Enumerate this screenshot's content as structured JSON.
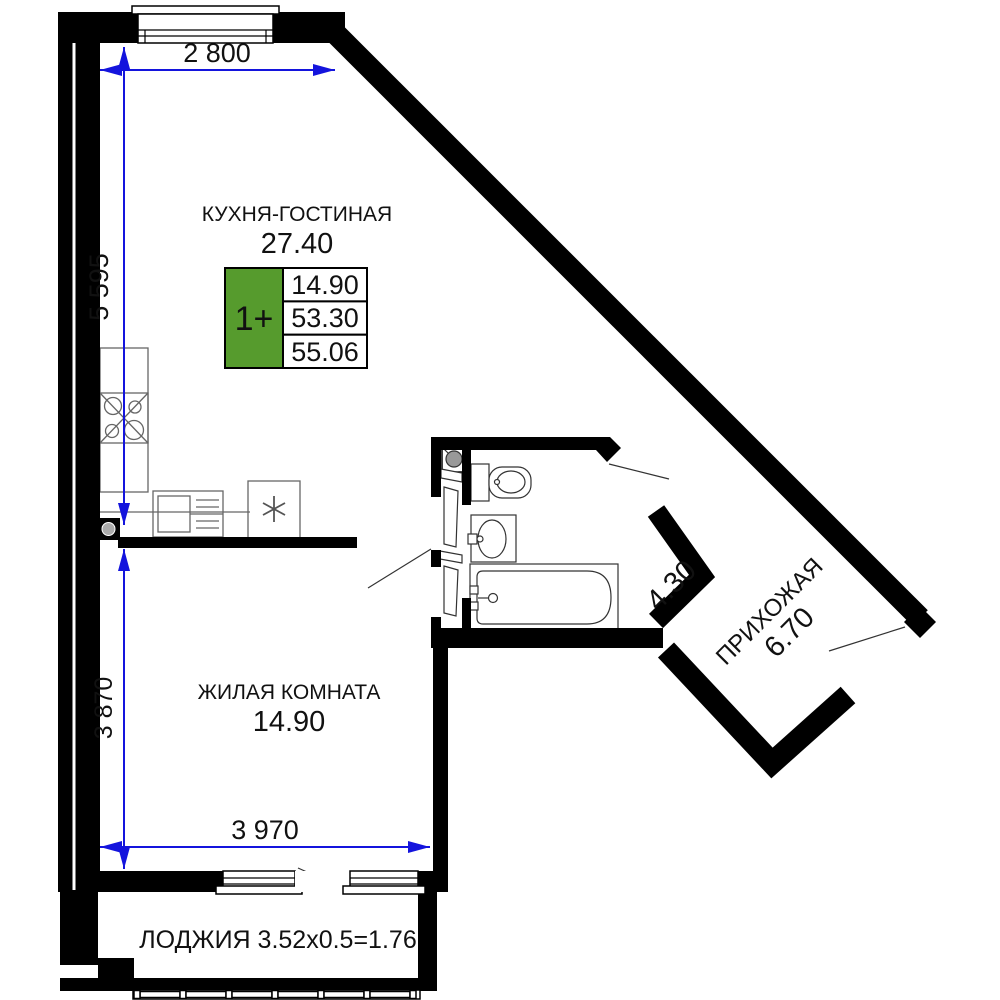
{
  "plan": {
    "dimensions": {
      "top": "2 800",
      "left_upper": "5 595",
      "left_lower": "3 870",
      "bottom": "3 970"
    },
    "rooms": {
      "kitchen_living": {
        "name": "КУХНЯ-ГОСТИНАЯ",
        "area": "27.40"
      },
      "living_room": {
        "name": "ЖИЛАЯ КОМНАТА",
        "area": "14.90"
      },
      "hallway": {
        "name": "ПРИХОЖАЯ",
        "area": "6.70"
      },
      "bathroom": {
        "area": "4.30"
      },
      "loggia": {
        "label": "ЛОДЖИЯ 3.52x0.5=1.76"
      }
    },
    "info_badge": {
      "type": "1+",
      "living_area": "14.90",
      "apartment_area": "53.30",
      "total_area": "55.06"
    },
    "colors": {
      "badge_green": "#569b2d",
      "dimension_blue": "#1414dd",
      "wall_black": "#000000"
    }
  }
}
